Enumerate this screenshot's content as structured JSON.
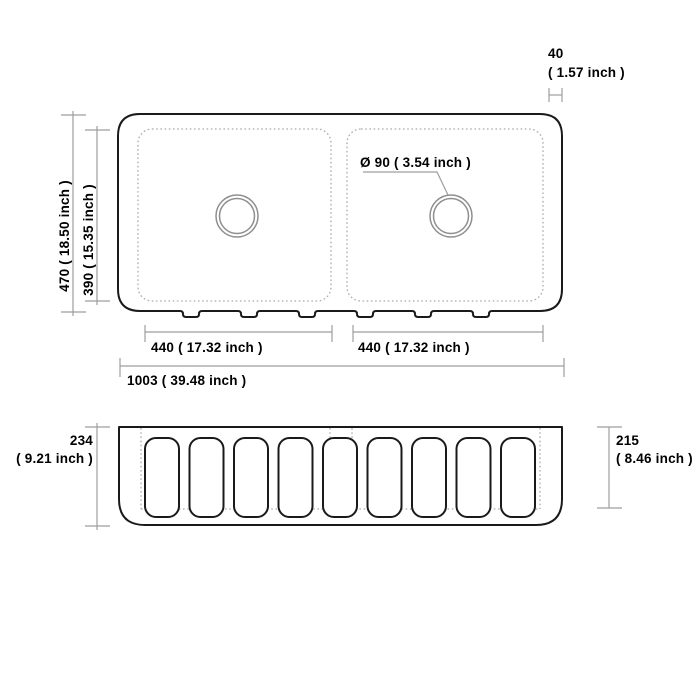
{
  "drawing_title": "double bowl fluted apron farmhouse sink dimension drawing",
  "colors": {
    "background": "#ffffff",
    "outline": "#1a1a1a",
    "dimension_line": "#9e9e9e",
    "dotted_line": "#ababab",
    "drain_circle": "#8f8f8f",
    "text": "#000000"
  },
  "top_view": {
    "overall_width_label": "1003 ( 39.48 inch )",
    "overall_depth_label": "470 ( 18.50 inch )",
    "bowl_depth_label": "390 ( 15.35 inch )",
    "left_bowl_width_label": "440 ( 17.32 inch )",
    "right_bowl_width_label": "440 ( 17.32 inch )",
    "rim_width_value": "40",
    "rim_width_inch": "( 1.57 inch )",
    "drain_diameter_label": "Ø 90 ( 3.54 inch )"
  },
  "front_view": {
    "overall_height_value": "234",
    "overall_height_inch": "( 9.21 inch )",
    "apron_height_value": "215",
    "apron_height_inch": "( 8.46 inch )",
    "flute_count": 9
  }
}
